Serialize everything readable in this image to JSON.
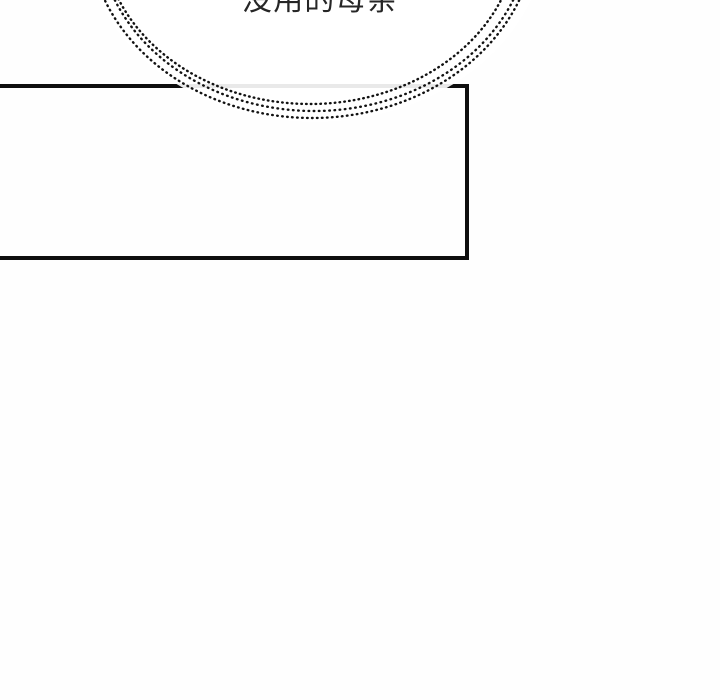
{
  "scene": {
    "type": "comic-panel",
    "background": "#fefefe"
  },
  "speech_bubble": {
    "text": "没用的母亲",
    "style": "whisper-dotted-outline",
    "outline_rings": 3,
    "fill": "#ffffff",
    "clipped_at_top": true
  },
  "panel": {
    "description": "empty rectangular panel frame, open at left image edge",
    "border_color": "#0e0e0e",
    "border_under_bubble_color": "#e9e9e9"
  },
  "colors": {
    "ink": "#121212",
    "panel_border": "#0e0e0e",
    "text": "#262626",
    "bubble_fill": "#ffffff"
  }
}
